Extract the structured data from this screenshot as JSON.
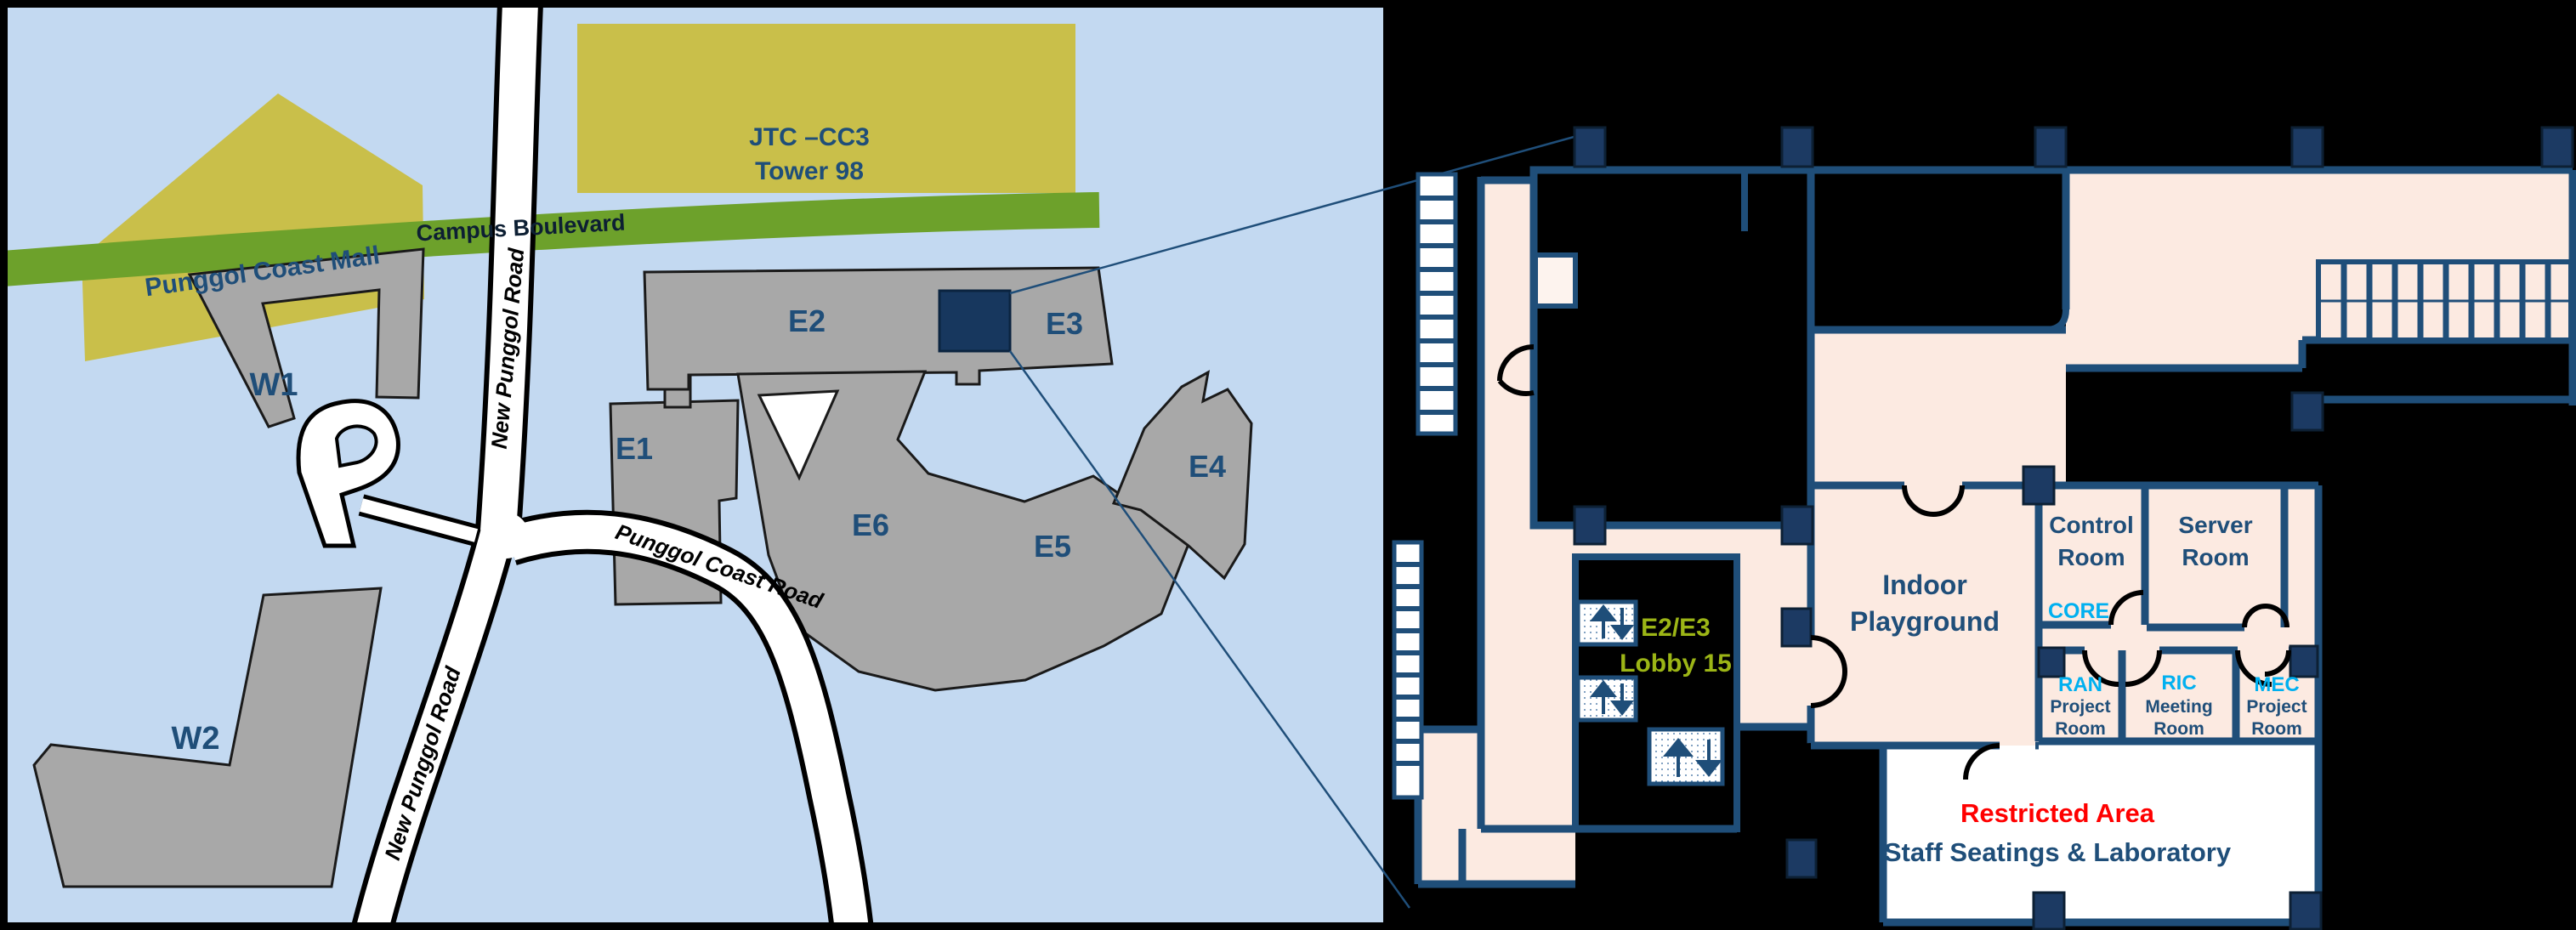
{
  "map": {
    "background_color": "#c3d9f1",
    "border_color": "#000000",
    "building_color": "#a8a8a8",
    "landmark_color": "#c9bf4a",
    "label_color": "#1f4e79",
    "highlight_color": "#17375e",
    "landmarks": {
      "mall": {
        "label": "Punggol Coast Mall"
      },
      "jtc": {
        "line1": "JTC –CC3",
        "line2": "Tower 98"
      }
    },
    "roads": {
      "campus_boulevard": {
        "label": "Campus Boulevard",
        "color": "#6da12b"
      },
      "new_punggol_upper": {
        "label": "New Punggol Road"
      },
      "new_punggol_lower": {
        "label": "New Punggol Road"
      },
      "punggol_coast": {
        "label": "Punggol Coast Road"
      }
    },
    "buildings": {
      "w1": "W1",
      "w2": "W2",
      "e1": "E1",
      "e2": "E2",
      "e3": "E3",
      "e4": "E4",
      "e5": "E5",
      "e6": "E6"
    }
  },
  "floorplan": {
    "colors": {
      "floor": "#fceae1",
      "wall": "#1f4e79",
      "pillar": "#1c3a63",
      "accent_cyan": "#00b0f0",
      "accent_green": "#9cb516",
      "restricted_red": "#ff0000",
      "restricted_floor": "#ffffff"
    },
    "lobby": {
      "line1": "E2/E3",
      "line2": "Lobby 15"
    },
    "rooms": {
      "indoor_playground": {
        "line1": "Indoor",
        "line2": "Playground"
      },
      "control_room": {
        "line1": "Control",
        "line2": "Room",
        "tag": "CORE"
      },
      "server_room": {
        "line1": "Server",
        "line2": "Room"
      },
      "ran_project_room": {
        "tag": "RAN",
        "line1": "Project",
        "line2": "Room"
      },
      "ric_meeting_room": {
        "tag": "RIC",
        "line1": "Meeting",
        "line2": "Room"
      },
      "mec_project_room": {
        "tag": "MEC",
        "line1": "Project",
        "line2": "Room"
      },
      "restricted_area": {
        "line1": "Restricted Area",
        "line2": "Staff Seatings & Laboratory"
      }
    }
  }
}
